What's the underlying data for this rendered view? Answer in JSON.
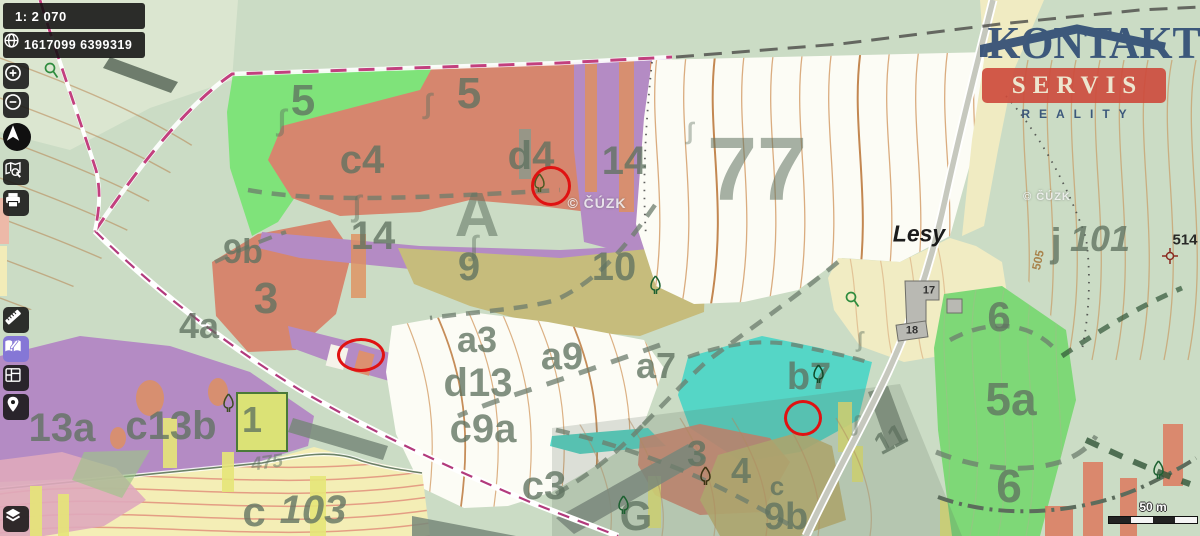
{
  "controls": {
    "scale": "1: 2 070",
    "coordinates": "1617099 6399319",
    "scalebar": "50 m"
  },
  "toolbar": {
    "icons": [
      "globe-icon",
      "zoom-in-icon",
      "zoom-out-icon",
      "compass-north-icon",
      "map-search-icon",
      "print-icon",
      "measure-icon",
      "draw-notes-icon",
      "layout-panels-icon",
      "location-pin-icon",
      "layers-icon"
    ]
  },
  "logo": {
    "line1": "KONTAKT",
    "line2": "SERVIS",
    "line3": "REALITY",
    "roof_color": "#2d4a73",
    "band_color": "#ce4a3b"
  },
  "map": {
    "colors": {
      "background": "#cbdcc5",
      "forest_green": "#7fe37a",
      "stand_salmon": "#d6866e",
      "stand_purple": "#b48bc4",
      "stand_olive": "#c6bc7c",
      "stand_teal": "#55d6c6",
      "village_yellow": "#f1ecc3",
      "marker_red": "#e01212"
    },
    "labels": [
      {
        "text": "5",
        "x": 303,
        "y": 101,
        "size": 44
      },
      {
        "text": "5",
        "x": 469,
        "y": 94,
        "size": 44
      },
      {
        "text": "c4",
        "x": 362,
        "y": 160,
        "size": 40
      },
      {
        "text": "d4",
        "x": 531,
        "y": 156,
        "size": 40
      },
      {
        "text": "14",
        "x": 624,
        "y": 161,
        "size": 40
      },
      {
        "text": "A",
        "x": 477,
        "y": 216,
        "size": 62,
        "opacity": 0.55
      },
      {
        "text": "14",
        "x": 373,
        "y": 236,
        "size": 40
      },
      {
        "text": "9",
        "x": 469,
        "y": 267,
        "size": 40
      },
      {
        "text": "10",
        "x": 614,
        "y": 267,
        "size": 40
      },
      {
        "text": "77",
        "x": 757,
        "y": 170,
        "size": 90,
        "opacity": 0.55
      },
      {
        "text": "9b",
        "x": 243,
        "y": 252,
        "size": 34
      },
      {
        "text": "3",
        "x": 266,
        "y": 299,
        "size": 44
      },
      {
        "text": "4a",
        "x": 199,
        "y": 326,
        "size": 36
      },
      {
        "text": "a3",
        "x": 477,
        "y": 340,
        "size": 36
      },
      {
        "text": "a9",
        "x": 562,
        "y": 357,
        "size": 38
      },
      {
        "text": "d13",
        "x": 478,
        "y": 383,
        "size": 40
      },
      {
        "text": "c9a",
        "x": 483,
        "y": 429,
        "size": 40
      },
      {
        "text": "c3",
        "x": 544,
        "y": 486,
        "size": 40
      },
      {
        "text": "a7",
        "x": 656,
        "y": 366,
        "size": 36
      },
      {
        "text": "b7",
        "x": 809,
        "y": 377,
        "size": 38
      },
      {
        "text": "3",
        "x": 697,
        "y": 454,
        "size": 36
      },
      {
        "text": "4",
        "x": 741,
        "y": 471,
        "size": 36
      },
      {
        "text": "c",
        "x": 777,
        "y": 486,
        "size": 26
      },
      {
        "text": "9b",
        "x": 786,
        "y": 517,
        "size": 38
      },
      {
        "text": "G",
        "x": 636,
        "y": 516,
        "size": 42
      },
      {
        "text": "11",
        "x": 891,
        "y": 440,
        "size": 30,
        "rotate": -28
      },
      {
        "text": "6",
        "x": 999,
        "y": 317,
        "size": 42
      },
      {
        "text": "5a",
        "x": 1011,
        "y": 399,
        "size": 46
      },
      {
        "text": "6",
        "x": 1009,
        "y": 486,
        "size": 46
      },
      {
        "text": "13a",
        "x": 62,
        "y": 428,
        "size": 40
      },
      {
        "text": "c13b",
        "x": 171,
        "y": 426,
        "size": 40
      },
      {
        "text": "1",
        "x": 252,
        "y": 420,
        "size": 36
      },
      {
        "text": "475",
        "x": 267,
        "y": 463,
        "size": 19,
        "italic": true,
        "rotate": -8,
        "opacity": 0.5
      },
      {
        "text": "c",
        "x": 254,
        "y": 512,
        "size": 42
      },
      {
        "text": "103",
        "x": 313,
        "y": 510,
        "size": 40,
        "italic": true
      },
      {
        "text": "j",
        "x": 1056,
        "y": 243,
        "size": 40
      },
      {
        "text": "101",
        "x": 1100,
        "y": 239,
        "size": 36,
        "italic": true
      },
      {
        "text": "505",
        "x": 1038,
        "y": 260,
        "size": 12,
        "color": "#a5793f",
        "rotate": -78,
        "opacity": 0.9
      },
      {
        "text": "514",
        "x": 1185,
        "y": 240,
        "size": 15,
        "color": "#1f1f1f",
        "opacity": 0.95
      },
      {
        "text": "17",
        "x": 929,
        "y": 291,
        "size": 11,
        "color": "#2a2a2a",
        "opacity": 0.95
      },
      {
        "text": "18",
        "x": 912,
        "y": 331,
        "size": 11,
        "color": "#2a2a2a",
        "opacity": 0.95
      },
      {
        "text": "Lesy",
        "x": 919,
        "y": 234,
        "size": 23,
        "color": "#101010",
        "italic": true,
        "opacity": 0.95
      },
      {
        "text": "∫",
        "x": 282,
        "y": 121,
        "size": 30,
        "opacity": 0.45
      },
      {
        "text": "∫",
        "x": 428,
        "y": 104,
        "size": 28,
        "opacity": 0.45
      },
      {
        "text": "∫",
        "x": 357,
        "y": 207,
        "size": 30,
        "opacity": 0.45
      },
      {
        "text": "∫",
        "x": 474,
        "y": 246,
        "size": 28,
        "opacity": 0.45
      },
      {
        "text": "∫",
        "x": 690,
        "y": 132,
        "size": 24,
        "opacity": 0.4
      },
      {
        "text": "∫",
        "x": 860,
        "y": 340,
        "size": 22,
        "opacity": 0.45
      },
      {
        "text": "∫",
        "x": 856,
        "y": 424,
        "size": 22,
        "opacity": 0.45
      }
    ],
    "watermarks": [
      {
        "text": "© ČÚZK",
        "x": 597,
        "y": 203,
        "size": 14
      },
      {
        "text": "© ČÚZK",
        "x": 1047,
        "y": 197,
        "size": 11
      }
    ],
    "markers": [
      {
        "x": 548,
        "y": 183,
        "rx": 17,
        "ry": 17
      },
      {
        "x": 358,
        "y": 352,
        "rx": 21,
        "ry": 14
      },
      {
        "x": 800,
        "y": 415,
        "rx": 16,
        "ry": 15
      }
    ],
    "trees": [
      {
        "x": 533,
        "y": 173,
        "c": "#4c5a22"
      },
      {
        "x": 649,
        "y": 275,
        "c": "#1c6030"
      },
      {
        "x": 812,
        "y": 364,
        "c": "#0f4a28"
      },
      {
        "x": 699,
        "y": 466,
        "c": "#3a3212"
      },
      {
        "x": 617,
        "y": 495,
        "c": "#1c6030"
      },
      {
        "x": 222,
        "y": 393,
        "c": "#3c4c20"
      },
      {
        "x": 1152,
        "y": 460,
        "c": "#1c6030"
      }
    ],
    "springs": [
      {
        "x": 44,
        "y": 62
      },
      {
        "x": 845,
        "y": 291
      }
    ],
    "trig_points": [
      {
        "x": 1160,
        "y": 240
      }
    ]
  }
}
